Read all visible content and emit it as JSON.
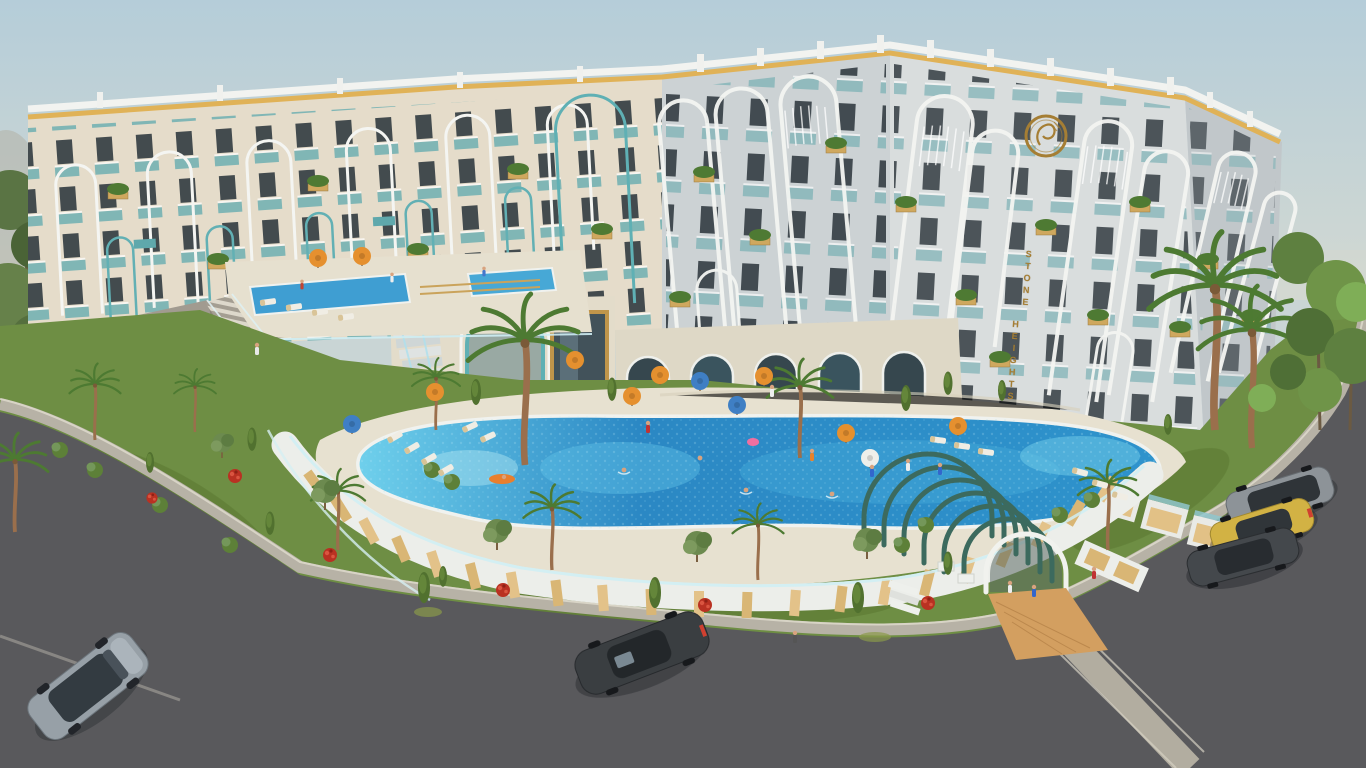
{
  "scene": {
    "type": "3d-architectural-exterior-render",
    "building_sign": {
      "word1": "STONE",
      "word2": "HEIGHTS"
    },
    "logo": {
      "name": "stone-heights-ring-monogram"
    },
    "palette": {
      "sky_top": "#b5cdd9",
      "sky_horizon": "#d3d9d2",
      "facade_cream": "#e5dcca",
      "facade_gray": "#ccd2d4",
      "facade_gray_light": "#d9dddd",
      "facade_gray_dark": "#c1c7ca",
      "trim_white": "#f2f3f0",
      "accent_gold": "#e0b257",
      "sign_gold": "#a57e34",
      "glass_teal": "#7fb4b7",
      "window_dark": "#333c42",
      "wood": "#d0a95f",
      "pool_deep": "#2b88c4",
      "pool_light": "#6fd0ec",
      "upper_pool": "#3f9ed2",
      "deck": "#e7e1d0",
      "grass": "#6e8e44",
      "road": "#59595c",
      "sidewalk": "#b7b2a6",
      "stone": "#a19b90",
      "arch_green": "#3c6a5e",
      "umbrella_orange": "#e5902f",
      "umbrella_blue": "#3f7fc4",
      "flower_red": "#bf3124"
    },
    "objects": {
      "pools": [
        "upper terrace pool",
        "grotto waterfall pool",
        "main lagoon pool"
      ],
      "umbrellas": {
        "orange": 9,
        "blue": 3,
        "white": 1
      },
      "cars": [
        {
          "type": "suv",
          "color": "#97a0a7"
        },
        {
          "type": "sedan",
          "color": "#3a3e41"
        },
        {
          "type": "wagon",
          "color": "#8d9398"
        },
        {
          "type": "sedan",
          "color": "#d2b244"
        },
        {
          "type": "sedan",
          "color": "#44484c"
        }
      ],
      "entrance": "arched pergola tunnel",
      "landscape": [
        "palm trees",
        "cypresses",
        "olive shrubs",
        "red flower beds",
        "lawn",
        "stone retaining wall with staircase"
      ]
    }
  }
}
